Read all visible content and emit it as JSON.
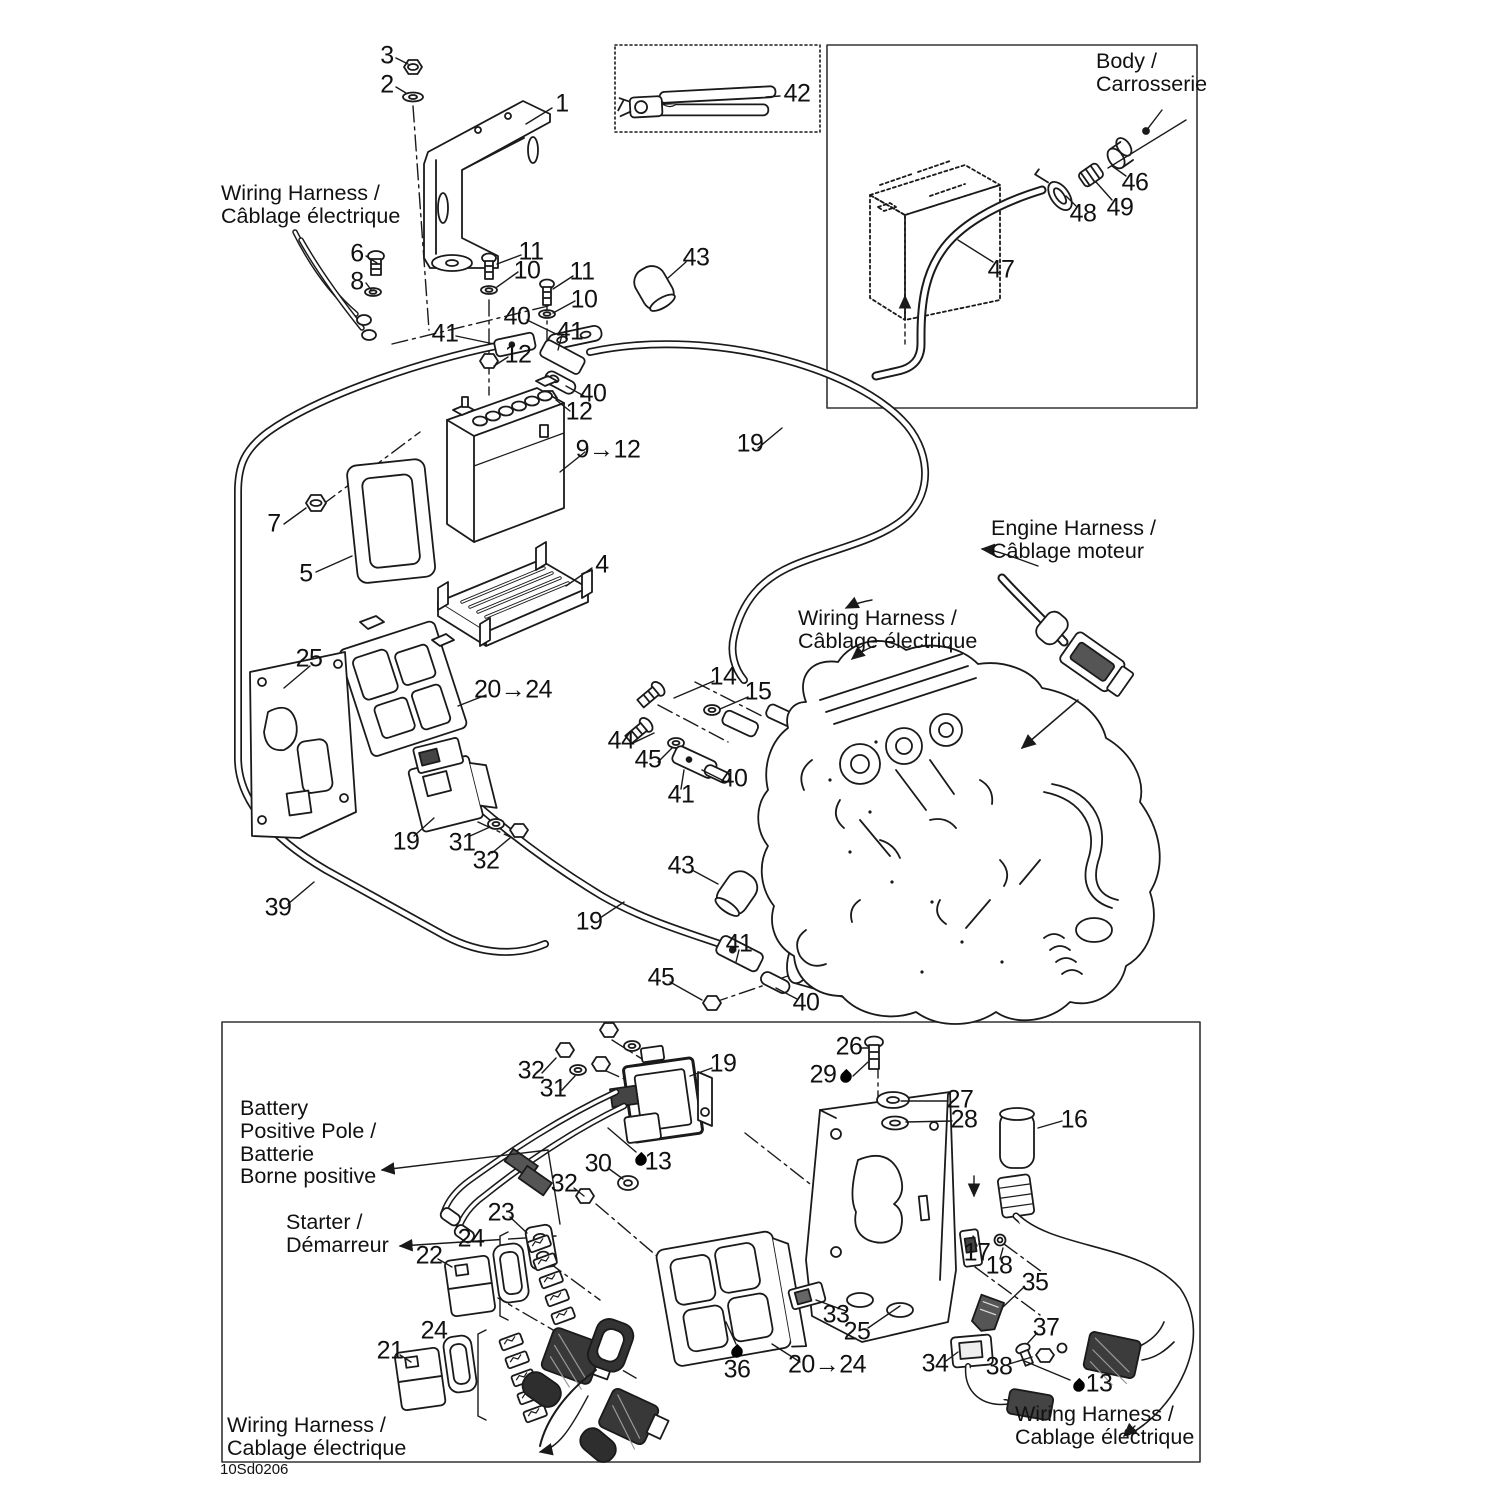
{
  "title": "Electrical System parts diagram",
  "colors": {
    "ink": "#1a1a1a",
    "background": "#ffffff",
    "shade": "#3a3a3a"
  },
  "footer_code": "10Sd0206",
  "annotations": {
    "texts": [
      {
        "id": "wiring-harness-top",
        "text": "Wiring Harness /\nCâblage électrique",
        "x": 221,
        "y": 182
      },
      {
        "id": "body-label",
        "text": "Body /\nCarrosserie",
        "x": 1096,
        "y": 50
      },
      {
        "id": "engine-harness-label",
        "text": "Engine Harness /\nCâblage moteur",
        "x": 991,
        "y": 517
      },
      {
        "id": "wiring-harness-mid",
        "text": "Wiring Harness /\nCâblage électrique",
        "x": 798,
        "y": 607
      },
      {
        "id": "battery-positive-pole",
        "text": "Battery\nPositive Pole /\nBatterie\nBorne positive",
        "x": 240,
        "y": 1097
      },
      {
        "id": "starter-label",
        "text": "Starter /\nDémarreur",
        "x": 286,
        "y": 1211
      },
      {
        "id": "wiring-harness-bottom-left",
        "text": "Wiring Harness /\nCablage électrique",
        "x": 227,
        "y": 1414
      },
      {
        "id": "wiring-harness-bottom-right",
        "text": "Wiring Harness /\nCablage électrique",
        "x": 1015,
        "y": 1403
      },
      {
        "id": "doc-code",
        "text": "10Sd0206",
        "x": 220,
        "y": 1462,
        "cls": "small"
      }
    ],
    "callouts": [
      {
        "n": "3",
        "x": 387,
        "y": 56
      },
      {
        "n": "2",
        "x": 387,
        "y": 85
      },
      {
        "n": "1",
        "x": 562,
        "y": 104
      },
      {
        "n": "42",
        "x": 797,
        "y": 94
      },
      {
        "n": "6",
        "x": 357,
        "y": 254
      },
      {
        "n": "8",
        "x": 357,
        "y": 282
      },
      {
        "n": "11",
        "x": 531,
        "y": 252
      },
      {
        "n": "10",
        "x": 527,
        "y": 271
      },
      {
        "n": "11",
        "x": 582,
        "y": 272
      },
      {
        "n": "10",
        "x": 584,
        "y": 300
      },
      {
        "n": "40",
        "x": 517,
        "y": 317
      },
      {
        "n": "41",
        "x": 445,
        "y": 334
      },
      {
        "n": "12",
        "x": 518,
        "y": 355
      },
      {
        "n": "41",
        "x": 570,
        "y": 332
      },
      {
        "n": "40",
        "x": 593,
        "y": 394
      },
      {
        "n": "12",
        "x": 579,
        "y": 412
      },
      {
        "n": "43",
        "x": 696,
        "y": 258
      },
      {
        "n": "9→12",
        "x": 608,
        "y": 450
      },
      {
        "n": "7",
        "x": 274,
        "y": 524
      },
      {
        "n": "5",
        "x": 306,
        "y": 574
      },
      {
        "n": "4",
        "x": 602,
        "y": 565
      },
      {
        "n": "25",
        "x": 309,
        "y": 659
      },
      {
        "n": "20→24",
        "x": 513,
        "y": 690
      },
      {
        "n": "19",
        "x": 750,
        "y": 444
      },
      {
        "n": "46",
        "x": 1135,
        "y": 183
      },
      {
        "n": "49",
        "x": 1120,
        "y": 208
      },
      {
        "n": "48",
        "x": 1083,
        "y": 214
      },
      {
        "n": "47",
        "x": 1001,
        "y": 270
      },
      {
        "n": "14",
        "x": 723,
        "y": 677
      },
      {
        "n": "15",
        "x": 758,
        "y": 692
      },
      {
        "n": "44",
        "x": 621,
        "y": 741
      },
      {
        "n": "45",
        "x": 648,
        "y": 760
      },
      {
        "n": "40",
        "x": 734,
        "y": 779
      },
      {
        "n": "41",
        "x": 681,
        "y": 795
      },
      {
        "n": "19",
        "x": 406,
        "y": 842
      },
      {
        "n": "31",
        "x": 462,
        "y": 843
      },
      {
        "n": "32",
        "x": 486,
        "y": 861
      },
      {
        "n": "39",
        "x": 278,
        "y": 908
      },
      {
        "n": "19",
        "x": 589,
        "y": 922
      },
      {
        "n": "43",
        "x": 681,
        "y": 866
      },
      {
        "n": "41",
        "x": 739,
        "y": 944
      },
      {
        "n": "45",
        "x": 661,
        "y": 978
      },
      {
        "n": "40",
        "x": 806,
        "y": 1003
      },
      {
        "n": "32",
        "x": 531,
        "y": 1071
      },
      {
        "n": "31",
        "x": 553,
        "y": 1089
      },
      {
        "n": "19",
        "x": 723,
        "y": 1064
      },
      {
        "n": "30",
        "x": 598,
        "y": 1164
      },
      {
        "n": "13",
        "x": 658,
        "y": 1162
      },
      {
        "n": "32",
        "x": 564,
        "y": 1184
      },
      {
        "n": "23",
        "x": 501,
        "y": 1213
      },
      {
        "n": "24",
        "x": 471,
        "y": 1239
      },
      {
        "n": "22",
        "x": 429,
        "y": 1256
      },
      {
        "n": "21",
        "x": 390,
        "y": 1351
      },
      {
        "n": "24",
        "x": 434,
        "y": 1331
      },
      {
        "n": "26",
        "x": 849,
        "y": 1047
      },
      {
        "n": "29",
        "x": 823,
        "y": 1075
      },
      {
        "n": "27",
        "x": 960,
        "y": 1100
      },
      {
        "n": "28",
        "x": 964,
        "y": 1120
      },
      {
        "n": "16",
        "x": 1074,
        "y": 1120
      },
      {
        "n": "17",
        "x": 977,
        "y": 1253
      },
      {
        "n": "18",
        "x": 999,
        "y": 1266
      },
      {
        "n": "35",
        "x": 1035,
        "y": 1283
      },
      {
        "n": "33",
        "x": 836,
        "y": 1315
      },
      {
        "n": "25",
        "x": 857,
        "y": 1332
      },
      {
        "n": "20→24",
        "x": 827,
        "y": 1365
      },
      {
        "n": "36",
        "x": 737,
        "y": 1370
      },
      {
        "n": "34",
        "x": 935,
        "y": 1364
      },
      {
        "n": "37",
        "x": 1046,
        "y": 1328
      },
      {
        "n": "38",
        "x": 999,
        "y": 1367
      },
      {
        "n": "13",
        "x": 1099,
        "y": 1384
      }
    ],
    "droplets": [
      {
        "x": 641,
        "y": 1160
      },
      {
        "x": 846,
        "y": 1077
      },
      {
        "x": 737,
        "y": 1352
      },
      {
        "x": 1079,
        "y": 1386
      }
    ]
  }
}
